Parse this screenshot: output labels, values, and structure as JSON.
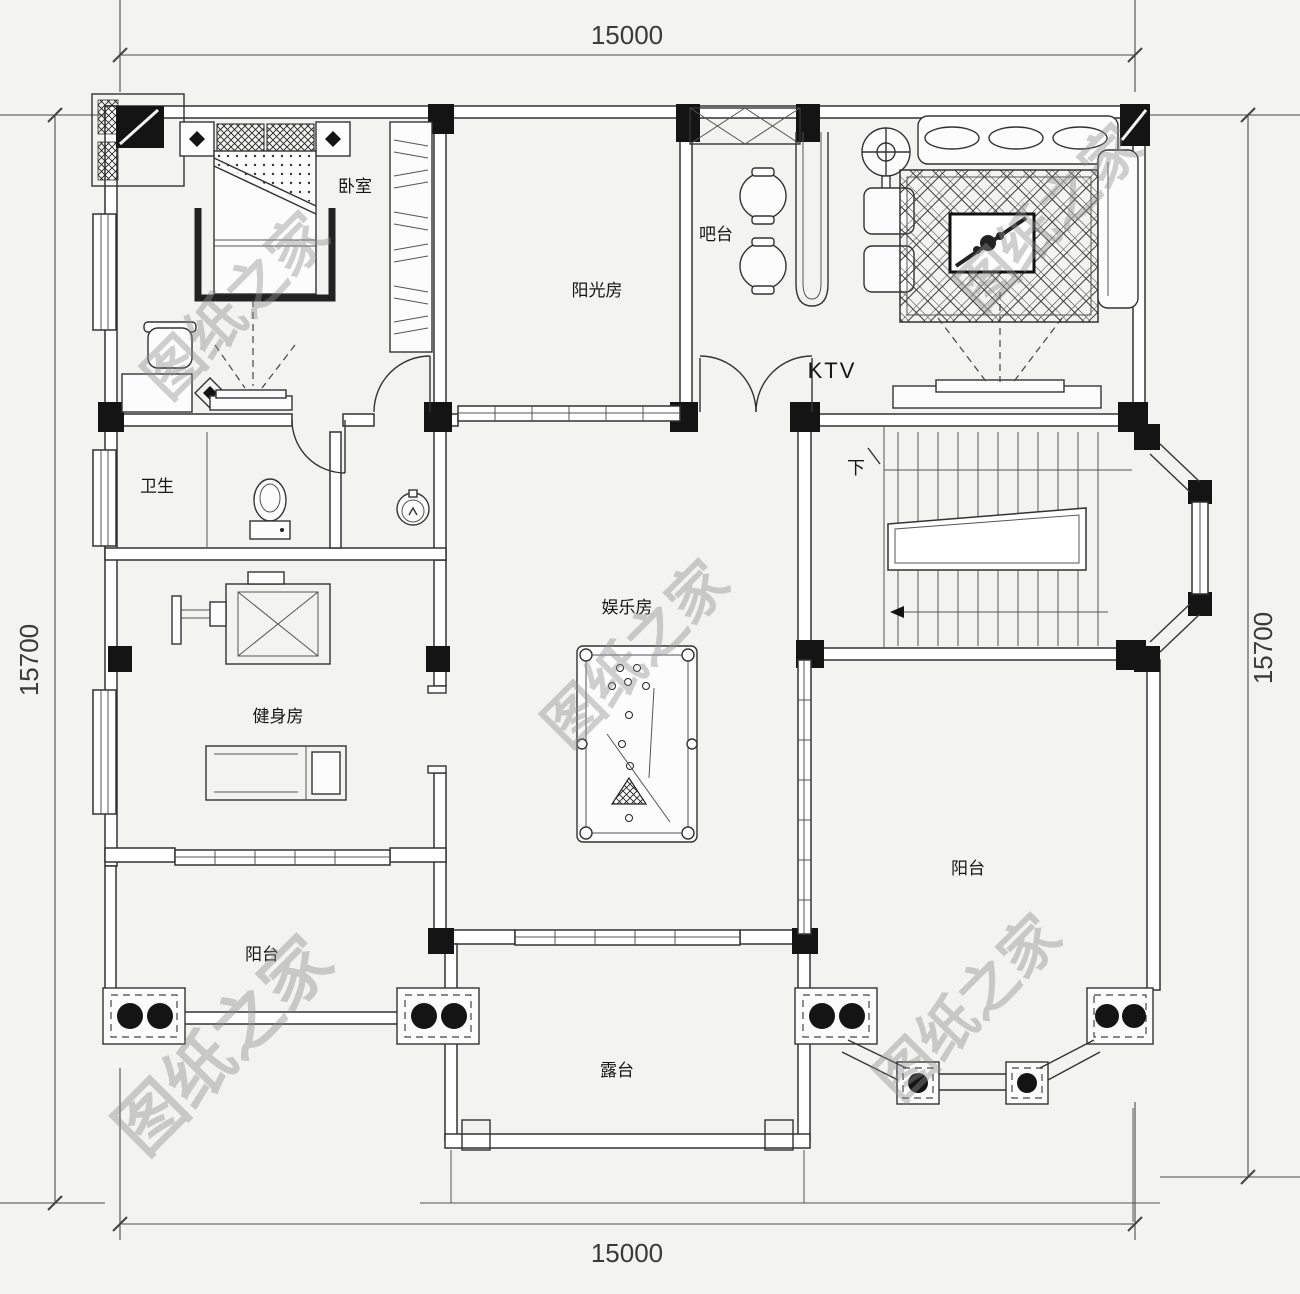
{
  "plan": {
    "watermark_text": "图纸之家",
    "dimensions": {
      "top": "15000",
      "bottom": "15000",
      "left": "15700",
      "right": "15700"
    },
    "rooms": {
      "bedroom": "卧室",
      "sunroom": "阳光房",
      "bar": "吧台",
      "ktv": "KTV",
      "bathroom": "卫生",
      "gym": "健身房",
      "game_room": "娱乐房",
      "balcony_right": "阳台",
      "balcony_left": "阳台",
      "terrace": "露台",
      "stairs_down": "下"
    },
    "colors": {
      "line": "#333333",
      "column_fill": "#141414",
      "watermark": "#8f8f8f",
      "background": "#f3f3f1"
    }
  }
}
